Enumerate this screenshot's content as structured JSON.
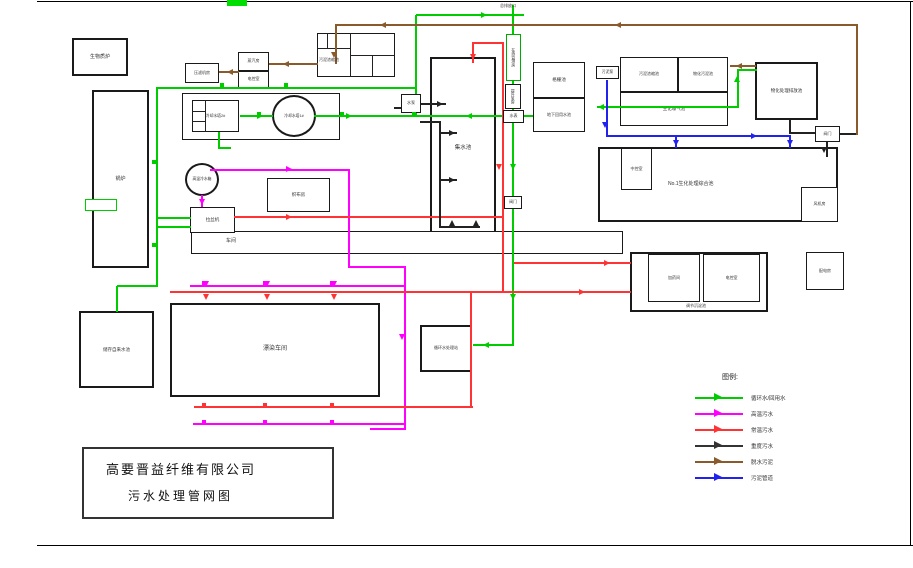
{
  "page": {
    "company": "高要晋益纤维有限公司",
    "drawing_title": "污水处理管网图"
  },
  "legend": {
    "title": "图例:",
    "entries": [
      {
        "label": "循环水/回用水",
        "color": "#00cc00"
      },
      {
        "label": "高温污水",
        "color": "#ff00ff"
      },
      {
        "label": "常温污水",
        "color": "#ff3333"
      },
      {
        "label": "重度污水",
        "color": "#333333"
      },
      {
        "label": "脱水污泥",
        "color": "#8a5a2a"
      },
      {
        "label": "污泥管道",
        "color": "#2222ee"
      }
    ]
  },
  "diagram": {
    "colors": {
      "g": "#00cc00",
      "m": "#ff00ff",
      "r": "#ff3333",
      "k": "#222222",
      "b": "#8a5a2a",
      "l": "#2222ee"
    },
    "boxes": [
      {
        "id": "biomass-furnace",
        "label": "生物质炉",
        "x": 72,
        "y": 38,
        "w": 56,
        "h": 38,
        "fs": 5,
        "b": 2
      },
      {
        "id": "boiler",
        "label": "锅炉",
        "x": 92,
        "y": 90,
        "w": 57,
        "h": 178,
        "fs": 5,
        "b": 2
      },
      {
        "id": "filter-press-room",
        "label": "压滤机房",
        "x": 185,
        "y": 63,
        "w": 34,
        "h": 20,
        "fs": 4
      },
      {
        "id": "steam-room",
        "label": "蒸汽房",
        "x": 238,
        "y": 52,
        "w": 31,
        "h": 19,
        "fs": 4
      },
      {
        "id": "power-control-room-a",
        "label": "电控室",
        "x": 238,
        "y": 71,
        "w": 31,
        "h": 17,
        "fs": 4
      },
      {
        "id": "sludge-thickening-pool-a",
        "x": 317,
        "y": 33,
        "w": 78,
        "h": 44
      },
      {
        "id": "cooling-tower-group",
        "x": 182,
        "y": 93,
        "w": 158,
        "h": 47
      },
      {
        "id": "cooling-tower-2",
        "label": "冷却水塔2#",
        "x": 192,
        "y": 100,
        "w": 47,
        "h": 32,
        "fs": 3.8
      },
      {
        "id": "cooling-tower-1",
        "label": "冷却水塔1#",
        "x": 272,
        "y": 95,
        "w": 44,
        "h": 42,
        "fs": 3.8,
        "shape": "circle",
        "b": 2
      },
      {
        "id": "collecting-tank",
        "label": "集水池",
        "x": 430,
        "y": 57,
        "w": 66,
        "h": 182,
        "fs": 5.5,
        "b": 2
      },
      {
        "id": "water-pump-a",
        "label": "水泵",
        "x": 401,
        "y": 94,
        "w": 20,
        "h": 19,
        "fs": 4,
        "topz": true
      },
      {
        "id": "online-monitoring-room",
        "label": "在线监测房",
        "x": 506,
        "y": 34,
        "w": 15,
        "h": 47,
        "fs": 3.8,
        "v": true,
        "bc": "#00aa00",
        "topz": true
      },
      {
        "id": "lift-pump-room",
        "label": "提升泵房",
        "x": 505,
        "y": 84,
        "w": 16,
        "h": 25,
        "fs": 3.8,
        "v": true,
        "topz": true
      },
      {
        "id": "water-meter",
        "label": "水表",
        "x": 503,
        "y": 110,
        "w": 21,
        "h": 13,
        "fs": 4,
        "topz": true
      },
      {
        "id": "valve-a",
        "label": "阀门",
        "x": 504,
        "y": 196,
        "w": 18,
        "h": 13,
        "fs": 4,
        "topz": true
      },
      {
        "id": "grille-pool",
        "label": "格栅池",
        "x": 533,
        "y": 62,
        "w": 52,
        "h": 36,
        "fs": 4.5
      },
      {
        "id": "underground-reuse-pool",
        "label": "地下回用水池",
        "x": 533,
        "y": 98,
        "w": 52,
        "h": 34,
        "fs": 4
      },
      {
        "id": "sludge-pump",
        "label": "污泥泵",
        "x": 596,
        "y": 66,
        "w": 23,
        "h": 13,
        "fs": 3.8,
        "topz": true
      },
      {
        "id": "sludge-thickening-pool-b",
        "label": "污泥浓缩池",
        "x": 620,
        "y": 57,
        "w": 58,
        "h": 35,
        "fs": 4
      },
      {
        "id": "chemical-sludge-pool",
        "label": "物化污泥池",
        "x": 678,
        "y": 57,
        "w": 50,
        "h": 35,
        "fs": 4
      },
      {
        "id": "aeration-pool",
        "label": "生化曝气池",
        "x": 620,
        "y": 92,
        "w": 108,
        "h": 34,
        "fs": 4.5
      },
      {
        "id": "chemical-discharge-pool",
        "label": "物化处理排放池",
        "x": 755,
        "y": 62,
        "w": 63,
        "h": 58,
        "fs": 4.5,
        "b": 2
      },
      {
        "id": "valve-b",
        "label": "阀门",
        "x": 815,
        "y": 126,
        "w": 25,
        "h": 16,
        "fs": 4,
        "topz": true
      },
      {
        "id": "no1-comprehensive-pool",
        "x": 598,
        "y": 147,
        "w": 240,
        "h": 75,
        "b": 2
      },
      {
        "id": "central-control-room",
        "label": "中控室",
        "x": 621,
        "y": 148,
        "w": 31,
        "h": 42,
        "fs": 4
      },
      {
        "id": "fan-room",
        "label": "风机房",
        "x": 801,
        "y": 187,
        "w": 37,
        "h": 35,
        "fs": 4
      },
      {
        "id": "regulating-sedimentation-pool",
        "x": 630,
        "y": 252,
        "w": 138,
        "h": 60,
        "b": 2
      },
      {
        "id": "dosing-room",
        "label": "加药间",
        "x": 648,
        "y": 254,
        "w": 52,
        "h": 48,
        "fs": 4
      },
      {
        "id": "power-control-room-b",
        "label": "电控室",
        "x": 703,
        "y": 254,
        "w": 57,
        "h": 48,
        "fs": 4
      },
      {
        "id": "power-distribution-room",
        "label": "配电房",
        "x": 806,
        "y": 252,
        "w": 38,
        "h": 38,
        "fs": 4
      },
      {
        "id": "circulating-water-station",
        "label": "循环水处理站",
        "x": 420,
        "y": 325,
        "w": 52,
        "h": 47,
        "fs": 4,
        "b": 2
      },
      {
        "id": "bleaching-dyeing-workshop",
        "label": "漂染车间",
        "x": 170,
        "y": 303,
        "w": 210,
        "h": 94,
        "fs": 6,
        "b": 2
      },
      {
        "id": "tap-water-pool",
        "label": "储存自来水池",
        "x": 79,
        "y": 311,
        "w": 75,
        "h": 77,
        "fs": 4.5,
        "b": 2
      },
      {
        "id": "workshop-strip",
        "x": 191,
        "y": 231,
        "w": 432,
        "h": 23
      },
      {
        "id": "drawing-machine",
        "label": "拉丝机",
        "x": 190,
        "y": 207,
        "w": 45,
        "h": 26,
        "fs": 4.5
      },
      {
        "id": "hot-water-tank",
        "label": "高温冷水箱",
        "x": 185,
        "y": 163,
        "w": 34,
        "h": 33,
        "fs": 3.8,
        "shape": "circle",
        "b": 2
      },
      {
        "id": "weaving-room",
        "label": "织布房",
        "x": 267,
        "y": 178,
        "w": 63,
        "h": 34,
        "fs": 4.5
      },
      {
        "id": "green-connector-box",
        "x": 85,
        "y": 199,
        "w": 32,
        "h": 12,
        "bc": "#00cc00"
      }
    ],
    "labels": [
      {
        "id": "outfall-label",
        "text": "总排放口",
        "x": 500,
        "y": 3,
        "fs": 4
      },
      {
        "id": "thickener-a-label",
        "text": "污泥浓缩池",
        "x": 319,
        "y": 57,
        "fs": 4
      },
      {
        "id": "comprehensive-pool-label",
        "text": "No.1生化处理综合池",
        "x": 668,
        "y": 180,
        "fs": 5
      },
      {
        "id": "regulating-pool-label",
        "text": "调节沉淀池",
        "x": 686,
        "y": 303,
        "fs": 4
      },
      {
        "id": "workshop-strip-label",
        "text": "车间",
        "x": 226,
        "y": 237,
        "fs": 5
      }
    ],
    "lines": [
      [
        "g",
        416,
        14,
        108,
        2
      ],
      [
        "g",
        415,
        15,
        2,
        101
      ],
      [
        "g",
        240,
        115,
        33,
        2
      ],
      [
        "g",
        314,
        115,
        219,
        2
      ],
      [
        "g",
        597,
        106,
        141,
        2
      ],
      [
        "g",
        737,
        70,
        2,
        38
      ],
      [
        "g",
        737,
        69,
        20,
        2
      ],
      [
        "g",
        512,
        5,
        2,
        340
      ],
      [
        "g",
        473,
        344,
        41,
        2
      ],
      [
        "g",
        156,
        88,
        2,
        198
      ],
      [
        "g",
        117,
        285,
        41,
        2
      ],
      [
        "g",
        116,
        286,
        2,
        26
      ],
      [
        "g",
        156,
        87,
        261,
        2
      ],
      [
        "g",
        157,
        217,
        34,
        2
      ],
      [
        "g",
        157,
        226,
        34,
        2
      ],
      [
        "g",
        218,
        132,
        2,
        16
      ],
      [
        "g",
        218,
        147,
        13,
        2
      ],
      [
        "m",
        210,
        169,
        140,
        2
      ],
      [
        "m",
        348,
        169,
        2,
        99
      ],
      [
        "m",
        348,
        266,
        58,
        2
      ],
      [
        "m",
        404,
        266,
        2,
        164
      ],
      [
        "m",
        370,
        428,
        36,
        2
      ],
      [
        "m",
        193,
        423,
        213,
        2
      ],
      [
        "m",
        190,
        285,
        216,
        2
      ],
      [
        "m",
        201,
        195,
        2,
        12
      ],
      [
        "r",
        234,
        216,
        270,
        2
      ],
      [
        "r",
        502,
        43,
        2,
        250
      ],
      [
        "r",
        473,
        42,
        31,
        2
      ],
      [
        "r",
        472,
        42,
        2,
        21
      ],
      [
        "r",
        170,
        291,
        461,
        2
      ],
      [
        "r",
        194,
        406,
        279,
        2
      ],
      [
        "r",
        470,
        291,
        2,
        117
      ],
      [
        "r",
        514,
        262,
        117,
        2
      ],
      [
        "k",
        421,
        103,
        25,
        2
      ],
      [
        "k",
        394,
        107,
        9,
        2
      ],
      [
        "k",
        420,
        121,
        20,
        2
      ],
      [
        "k",
        439,
        121,
        2,
        107
      ],
      [
        "k",
        441,
        132,
        16,
        2
      ],
      [
        "k",
        441,
        179,
        16,
        2
      ],
      [
        "k",
        439,
        226,
        41,
        2
      ],
      [
        "k",
        789,
        120,
        2,
        14
      ],
      [
        "k",
        789,
        132,
        28,
        2
      ],
      [
        "k",
        826,
        142,
        2,
        15
      ],
      [
        "k",
        839,
        133,
        19,
        2
      ],
      [
        "k",
        350,
        33,
        1,
        44
      ],
      [
        "k",
        317,
        48,
        33,
        1
      ],
      [
        "k",
        327,
        33,
        1,
        15
      ],
      [
        "k",
        335,
        33,
        1,
        15
      ],
      [
        "k",
        372,
        55,
        1,
        22
      ],
      [
        "k",
        350,
        55,
        45,
        1
      ],
      [
        "k",
        205,
        100,
        1,
        32
      ],
      [
        "k",
        192,
        111,
        13,
        1
      ],
      [
        "k",
        192,
        121,
        13,
        1
      ],
      [
        "b",
        335,
        24,
        522,
        2
      ],
      [
        "b",
        335,
        25,
        2,
        39
      ],
      [
        "b",
        856,
        24,
        2,
        111
      ],
      [
        "b",
        219,
        71,
        20,
        2
      ],
      [
        "b",
        269,
        63,
        49,
        2
      ],
      [
        "b",
        730,
        65,
        26,
        2
      ],
      [
        "l",
        606,
        80,
        2,
        57
      ],
      [
        "l",
        606,
        135,
        185,
        2
      ],
      [
        "l",
        675,
        135,
        2,
        13
      ],
      [
        "l",
        789,
        135,
        2,
        13
      ]
    ],
    "arrows": [
      [
        "g",
        487,
        15,
        "r"
      ],
      [
        "g",
        598,
        107,
        "l"
      ],
      [
        "g",
        263,
        116,
        "r"
      ],
      [
        "g",
        352,
        116,
        "r"
      ],
      [
        "g",
        466,
        116,
        "l"
      ],
      [
        "g",
        737,
        76,
        "u"
      ],
      [
        "g",
        513,
        170,
        "d"
      ],
      [
        "g",
        513,
        300,
        "d"
      ],
      [
        "g",
        483,
        345,
        "l"
      ],
      [
        "m",
        292,
        169,
        "r"
      ],
      [
        "m",
        202,
        205,
        "d"
      ],
      [
        "m",
        402,
        340,
        "d"
      ],
      [
        "m",
        206,
        287,
        "d"
      ],
      [
        "m",
        267,
        287,
        "d"
      ],
      [
        "m",
        334,
        287,
        "d"
      ],
      [
        "r",
        473,
        60,
        "d"
      ],
      [
        "r",
        499,
        170,
        "d"
      ],
      [
        "r",
        292,
        217,
        "r"
      ],
      [
        "r",
        585,
        292,
        "r"
      ],
      [
        "r",
        610,
        263,
        "r"
      ],
      [
        "r",
        206,
        300,
        "d"
      ],
      [
        "r",
        267,
        300,
        "d"
      ],
      [
        "r",
        334,
        300,
        "d"
      ],
      [
        "k",
        443,
        104,
        "r"
      ],
      [
        "k",
        455,
        133,
        "r"
      ],
      [
        "k",
        455,
        180,
        "r"
      ],
      [
        "k",
        452,
        220,
        "u"
      ],
      [
        "k",
        476,
        220,
        "u"
      ],
      [
        "k",
        824,
        153,
        "d"
      ],
      [
        "b",
        380,
        25,
        "l"
      ],
      [
        "b",
        615,
        25,
        "l"
      ],
      [
        "b",
        334,
        58,
        "d"
      ],
      [
        "b",
        227,
        72,
        "l"
      ],
      [
        "b",
        283,
        64,
        "l"
      ],
      [
        "b",
        736,
        66,
        "l"
      ],
      [
        "l",
        605,
        128,
        "d"
      ],
      [
        "l",
        757,
        136,
        "r"
      ],
      [
        "l",
        676,
        146,
        "d"
      ],
      [
        "l",
        790,
        146,
        "d"
      ]
    ],
    "markers": [
      [
        "g",
        259,
        114
      ],
      [
        "g",
        342,
        114
      ],
      [
        "g",
        414,
        114
      ],
      [
        "g",
        154,
        162
      ],
      [
        "g",
        154,
        245
      ],
      [
        "g",
        222,
        85
      ],
      [
        "g",
        286,
        85
      ],
      [
        "m",
        204,
        283
      ],
      [
        "m",
        265,
        283
      ],
      [
        "m",
        332,
        283
      ],
      [
        "m",
        204,
        422
      ],
      [
        "m",
        265,
        422
      ],
      [
        "m",
        332,
        422
      ],
      [
        "r",
        204,
        405
      ],
      [
        "r",
        265,
        405
      ],
      [
        "r",
        332,
        405
      ]
    ]
  }
}
